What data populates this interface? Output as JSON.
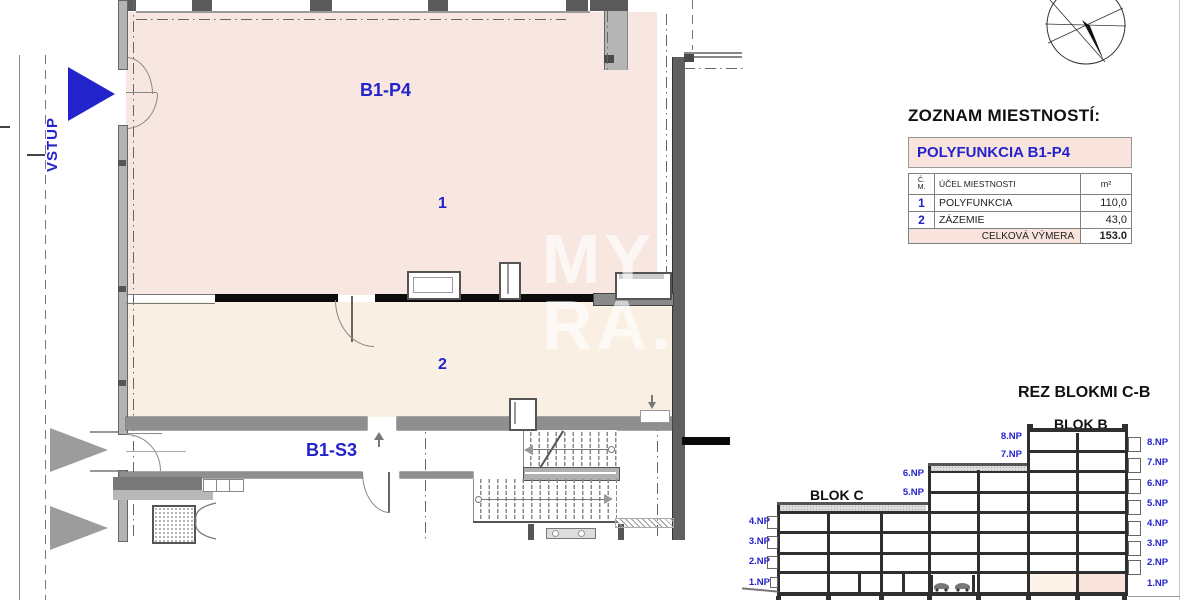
{
  "plan": {
    "entry_label": "VSTUP",
    "unit_label": "B1-P4",
    "room1_number": "1",
    "room2_number": "2",
    "basement_label": "B1-S3"
  },
  "watermark": {
    "line1": "MY",
    "line2": "RA."
  },
  "room_table": {
    "title": "ZOZNAM MIESTNOSTÍ:",
    "header": "POLYFUNKCIA B1-P4",
    "col_no_line1": "Č.",
    "col_no_line2": "M.",
    "col_purpose": "ÚČEL MIESTNOSTI",
    "col_area": "m²",
    "rows": [
      {
        "no": "1",
        "purpose": "POLYFUNKCIA",
        "area": "110,0"
      },
      {
        "no": "2",
        "purpose": "ZÁZEMIE",
        "area": "43,0"
      }
    ],
    "total_label": "CELKOVÁ VÝMERA",
    "total_value": "153.0"
  },
  "section": {
    "title": "REZ BLOKMI C-B",
    "blok_c": "BLOK C",
    "blok_b": "BLOK B",
    "left_floors": [
      "4.NP",
      "3.NP",
      "2.NP",
      "1.NP"
    ],
    "mid_upper_floors": [
      "8.NP",
      "7.NP"
    ],
    "mid_lower_floors": [
      "6.NP",
      "5.NP"
    ],
    "right_floors": [
      "8.NP",
      "7.NP",
      "6.NP",
      "5.NP",
      "4.NP",
      "3.NP",
      "2.NP",
      "1.NP"
    ]
  },
  "colors": {
    "accent_blue": "#2323cc",
    "room1_fill": "#f8e6e1",
    "room2_fill": "#f9efe2",
    "table_header_bg": "#f9e4dd",
    "highlight_cell": "#f8e4da",
    "wall_dark": "#5a5a5a"
  }
}
